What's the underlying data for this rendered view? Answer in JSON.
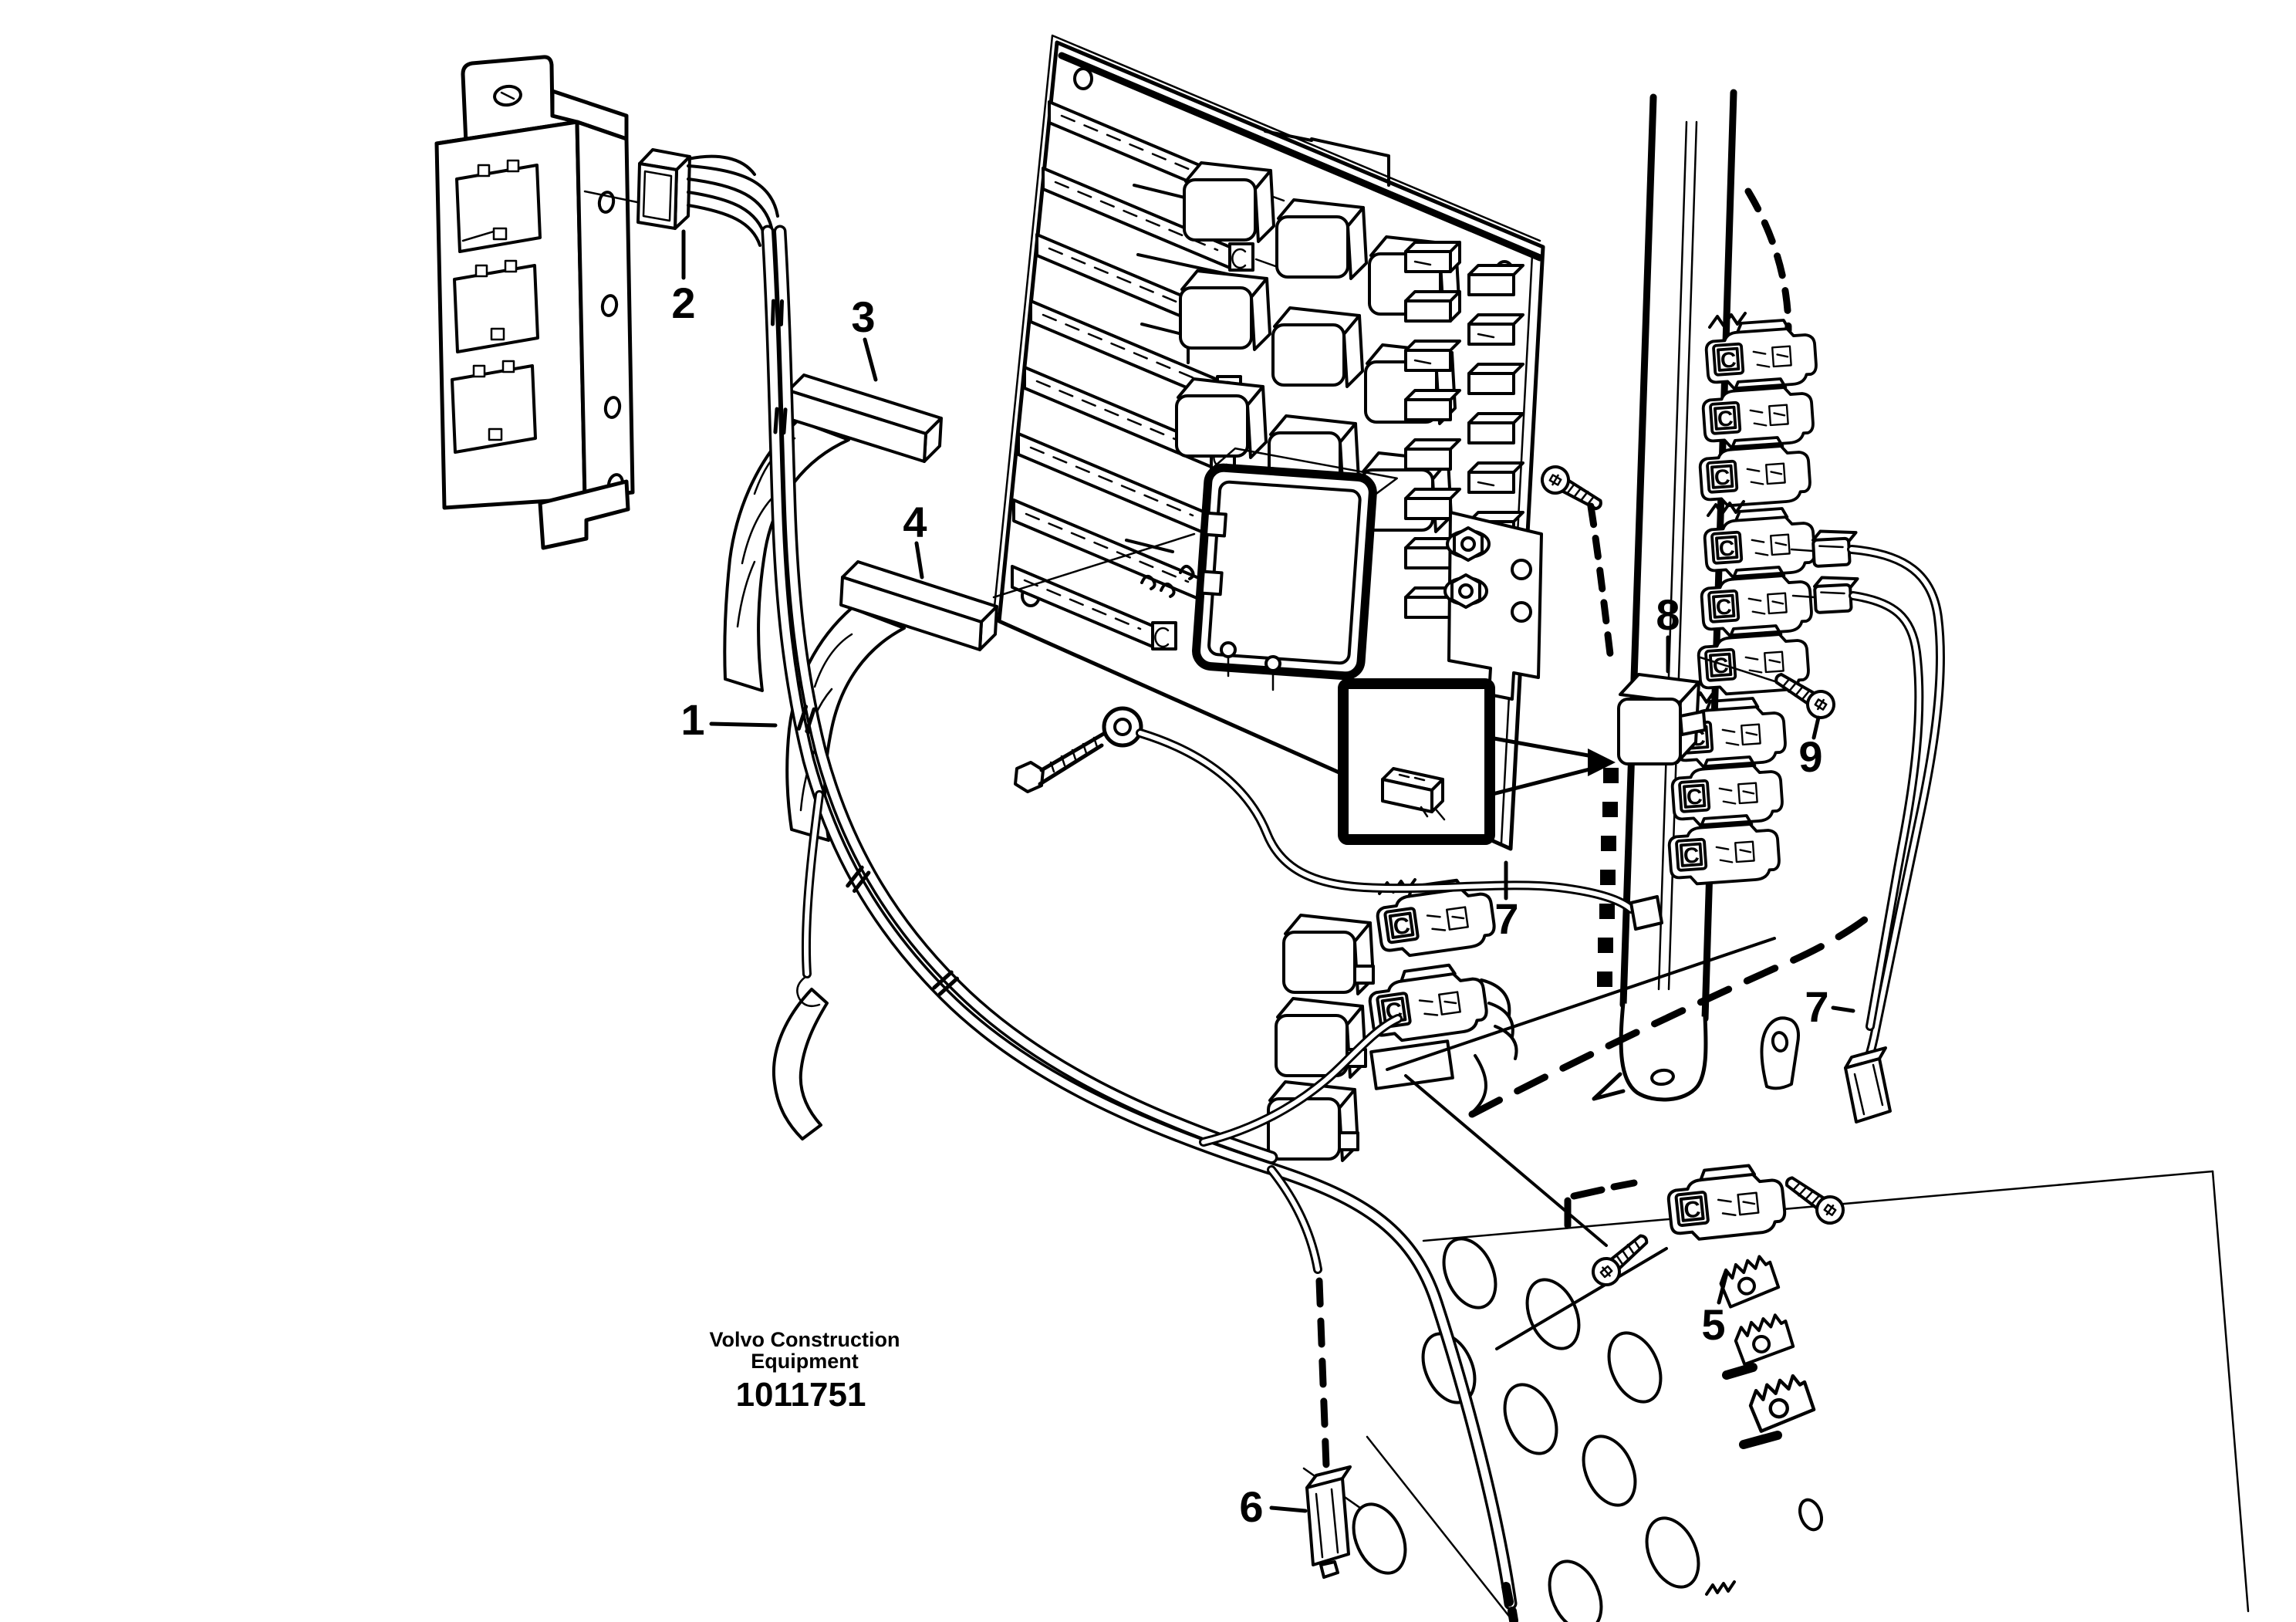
{
  "figure": {
    "brand_line1": "Volvo Construction",
    "brand_line2": "Equipment",
    "part_number": "1011751"
  },
  "markings": {
    "fuse_marking": "C"
  },
  "callouts": {
    "n1": {
      "label": "1"
    },
    "n2": {
      "label": "2"
    },
    "n3": {
      "label": "3"
    },
    "n4": {
      "label": "4"
    },
    "n5": {
      "label": "5"
    },
    "n6": {
      "label": "6"
    },
    "n7a": {
      "label": "7"
    },
    "n7b": {
      "label": "7"
    },
    "n8": {
      "label": "8"
    },
    "n9": {
      "label": "9"
    }
  },
  "colors": {
    "ink": "#000000",
    "paper": "#ffffff"
  }
}
